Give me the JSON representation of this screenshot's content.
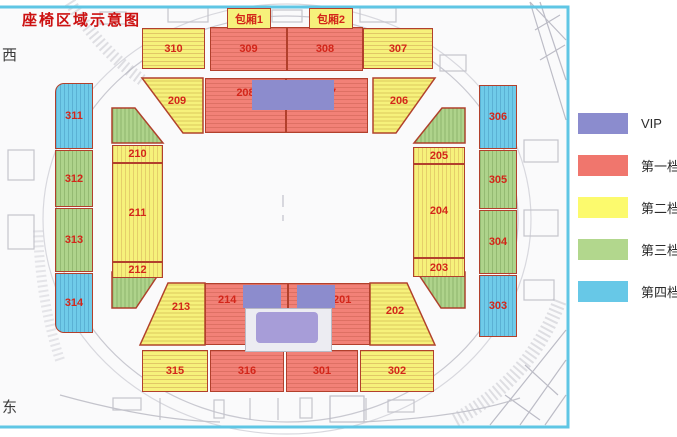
{
  "title": "座椅区域示意图",
  "compass": {
    "west": "西",
    "east": "东"
  },
  "suites": {
    "box1": "包厢1",
    "box2": "包厢2"
  },
  "legend": {
    "items": [
      {
        "label": "VIP",
        "color": "#8b8cce"
      },
      {
        "label": "第一档",
        "color": "#f0766d"
      },
      {
        "label": "第二档",
        "color": "#fcfa6d"
      },
      {
        "label": "第三档",
        "color": "#b2d78d"
      },
      {
        "label": "第四档",
        "color": "#67c8e7"
      }
    ]
  },
  "sections": {
    "s201": {
      "label": "201",
      "tier": "第一档"
    },
    "s202": {
      "label": "202",
      "tier": "第二档"
    },
    "s203": {
      "label": "203",
      "tier": "第二档"
    },
    "s204": {
      "label": "204",
      "tier": "第二档"
    },
    "s205": {
      "label": "205",
      "tier": "第二档"
    },
    "s206": {
      "label": "206",
      "tier": "第二档"
    },
    "s207": {
      "label": "207",
      "tier": "第一档"
    },
    "s208": {
      "label": "208",
      "tier": "第一档"
    },
    "s209": {
      "label": "209",
      "tier": "第二档"
    },
    "s210": {
      "label": "210",
      "tier": "第二档"
    },
    "s211": {
      "label": "211",
      "tier": "第二档"
    },
    "s212": {
      "label": "212",
      "tier": "第二档"
    },
    "s213": {
      "label": "213",
      "tier": "第二档"
    },
    "s214": {
      "label": "214",
      "tier": "第一档"
    },
    "s301": {
      "label": "301",
      "tier": "第一档"
    },
    "s302": {
      "label": "302",
      "tier": "第二档"
    },
    "s303": {
      "label": "303",
      "tier": "第四档"
    },
    "s304": {
      "label": "304",
      "tier": "第三档"
    },
    "s305": {
      "label": "305",
      "tier": "第三档"
    },
    "s306": {
      "label": "306",
      "tier": "第四档"
    },
    "s307": {
      "label": "307",
      "tier": "第二档"
    },
    "s308": {
      "label": "308",
      "tier": "第一档"
    },
    "s309": {
      "label": "309",
      "tier": "第一档"
    },
    "s310": {
      "label": "310",
      "tier": "第二档"
    },
    "s311": {
      "label": "311",
      "tier": "第四档"
    },
    "s312": {
      "label": "312",
      "tier": "第三档"
    },
    "s313": {
      "label": "313",
      "tier": "第三档"
    },
    "s314": {
      "label": "314",
      "tier": "第四档"
    },
    "s315": {
      "label": "315",
      "tier": "第二档"
    },
    "s316": {
      "label": "316",
      "tier": "第一档"
    }
  }
}
